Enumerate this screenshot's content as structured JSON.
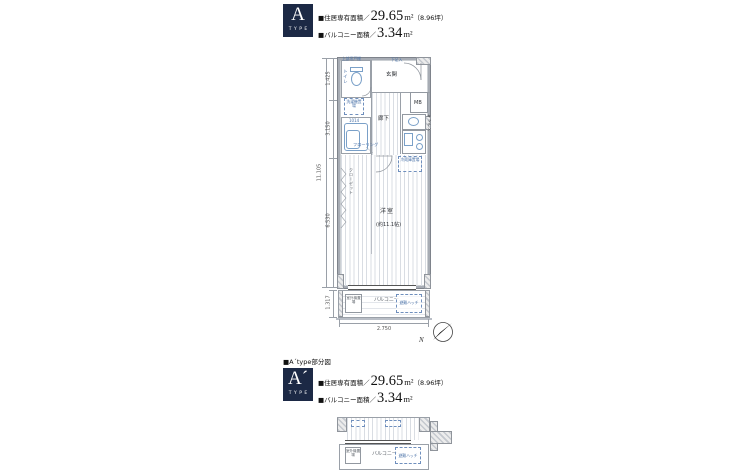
{
  "type_a": {
    "badge_letter": "A",
    "badge_type": "TYPE",
    "area_prefix": "■住居専有面積／",
    "area_value": "29.65",
    "area_unit": "m²",
    "area_note": "（8.96坪）",
    "balcony_prefix": "■バルコニー面積／",
    "balcony_value": "3.34",
    "balcony_unit": "m²"
  },
  "type_a2": {
    "heading": "■A´type部分図",
    "badge_letter": "A´",
    "badge_type": "TYPE",
    "area_prefix": "■住居専有面積／",
    "area_value": "29.65",
    "area_unit": "m²",
    "area_note": "（8.96坪）",
    "balcony_prefix": "■バルコニー面積／",
    "balcony_value": "3.34",
    "balcony_unit": "m²"
  },
  "plan": {
    "toilet": "トイレ",
    "upper_shelf": "上部吊戸棚",
    "shoe_box": "下足入",
    "entrance": "玄関",
    "mb": "MB",
    "washer": "洗濯機置場",
    "bath": "1014",
    "hallway": "廊下",
    "kitchen": "キッチン",
    "fridge": "冷蔵庫置場",
    "flooring": "フローリング",
    "closet": "クローゼット",
    "room": "洋室",
    "room_size": "(約11.1帖)",
    "balcony": "バルコニー",
    "hatch": "避難ハッチ",
    "outdoor_unit": "室外機置場",
    "dims": {
      "d1": "1.425",
      "d2": "3.150",
      "d3": "6.530",
      "total": "11.105",
      "balcony": "1.317",
      "width": "2.750"
    },
    "north": "N"
  },
  "partial": {
    "balcony": "バルコニー",
    "hatch": "避難ハッチ",
    "outdoor_unit": "室外機置場"
  }
}
